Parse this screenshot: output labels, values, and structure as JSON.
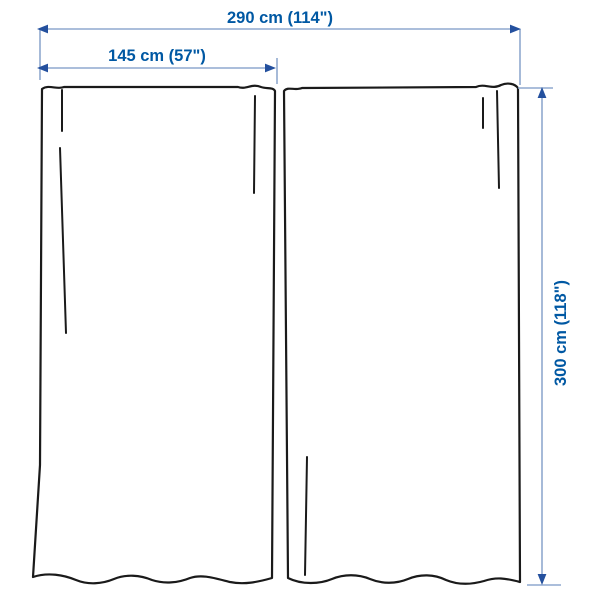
{
  "labels": {
    "total_width": "290 cm (114\")",
    "panel_width": "145 cm (57\")",
    "height": "300 cm (118\")"
  },
  "colors": {
    "label_text": "#0058a3",
    "dimension_line": "#8fa9cf",
    "arrowhead": "#24509e",
    "curtain_outline": "#1a1a1a",
    "background": "#ffffff"
  }
}
